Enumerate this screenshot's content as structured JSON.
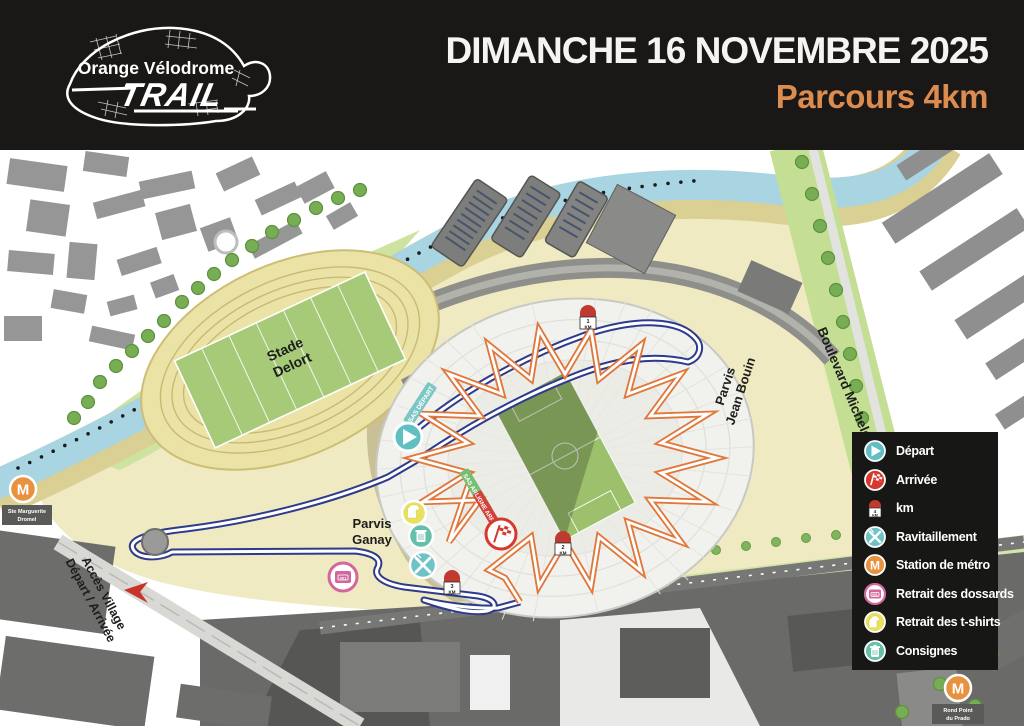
{
  "header": {
    "date": "DIMANCHE 16 NOVEMBRE 2025",
    "subtitle": "Parcours 4km",
    "logo": {
      "top": "Orange Vélodrome",
      "main": "TRAIL"
    }
  },
  "map": {
    "labels": {
      "stade_delort_1": "Stade",
      "stade_delort_2": "Delort",
      "parvis_jean_bouin_1": "Parvis",
      "parvis_jean_bouin_2": "Jean Bouin",
      "boulevard_michelet": "Boulevard Michelet",
      "parvis_ganay_1": "Parvis",
      "parvis_ganay_2": "Ganay",
      "acces_village_1": "Accès Village",
      "acces_village_2": "Départ / Arrivée",
      "metro_left_1": "Ste Marguerite",
      "metro_left_2": "Dromel",
      "metro_right_1": "Rond Point",
      "metro_right_2": "du Prado"
    },
    "banners": {
      "sas_depart": "SAS DÉPART",
      "arrivee_green": "SAS ARRIVÉE",
      "arrivee_red": "LIGNE ARRIVÉE"
    },
    "markers": {
      "km1": "1",
      "km2": "2",
      "km3": "3",
      "km_unit": "KM",
      "metro_letter": "M",
      "bib_number": "001"
    }
  },
  "legend": {
    "items": [
      {
        "label": "Départ",
        "icon": "depart-icon"
      },
      {
        "label": "Arrivée",
        "icon": "arrivee-icon"
      },
      {
        "label": "km",
        "icon": "km-marker-icon"
      },
      {
        "label": "Ravitaillement",
        "icon": "ravitaillement-icon"
      },
      {
        "label": "Station de métro",
        "icon": "metro-icon"
      },
      {
        "label": "Retrait des dossards",
        "icon": "bib-icon"
      },
      {
        "label": "Retrait des t-shirts",
        "icon": "tshirt-icon"
      },
      {
        "label": "Consignes",
        "icon": "consignes-icon"
      }
    ],
    "km_icon_number": "4",
    "km_icon_unit": "KM"
  },
  "colors": {
    "accent_orange": "#dd8c4f",
    "route_blue": "#2e3a8c",
    "route_orange": "#e0773b",
    "teal": "#5fbfc2",
    "finish_red": "#d6382f",
    "metro_orange": "#e8913f",
    "bib_pink": "#d2679c",
    "tshirt_yellow": "#e8e05e",
    "consignes_green": "#66bfa9",
    "header_bg": "#1a1816"
  }
}
